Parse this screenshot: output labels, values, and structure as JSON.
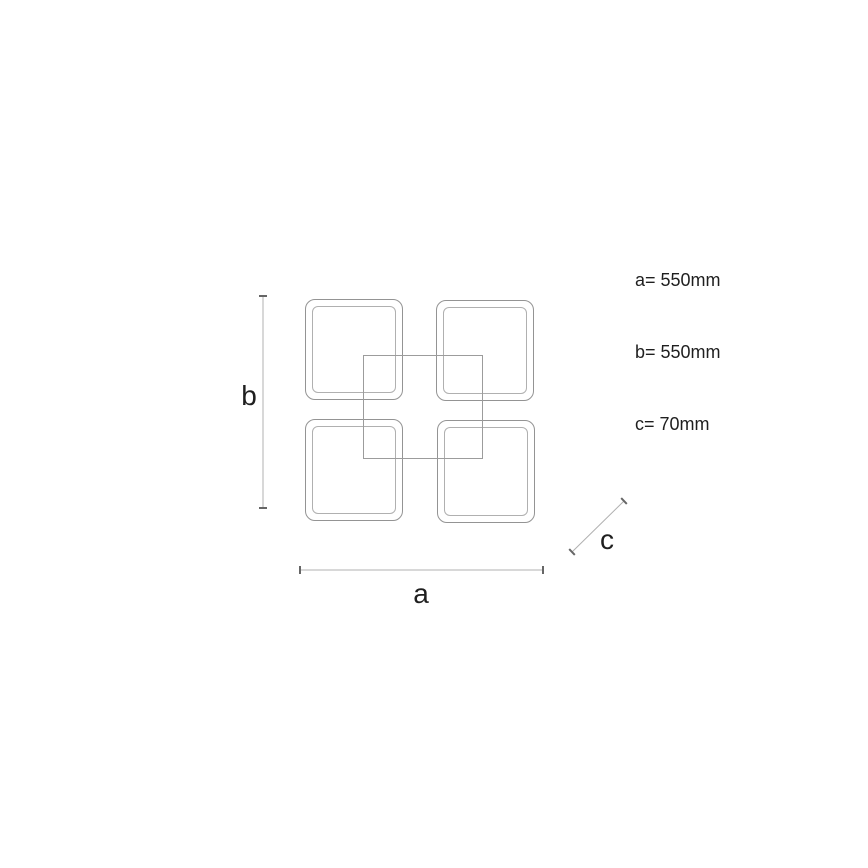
{
  "spec_list": {
    "lines": [
      "a= 550mm",
      "b= 550mm",
      "c= 70mm"
    ]
  },
  "dimension_labels": {
    "a": "a",
    "b": "b",
    "c": "c"
  },
  "dimensions": {
    "a_mm": 550,
    "b_mm": 550,
    "c_mm": 70
  },
  "colors": {
    "background": "#ffffff",
    "drawing_line": "#949494",
    "inner_line": "#b0b0b0",
    "frame_line": "#9c9c9c",
    "dim_line": "#b0b0b0",
    "tick": "#666666",
    "text": "#1f1f1f"
  }
}
